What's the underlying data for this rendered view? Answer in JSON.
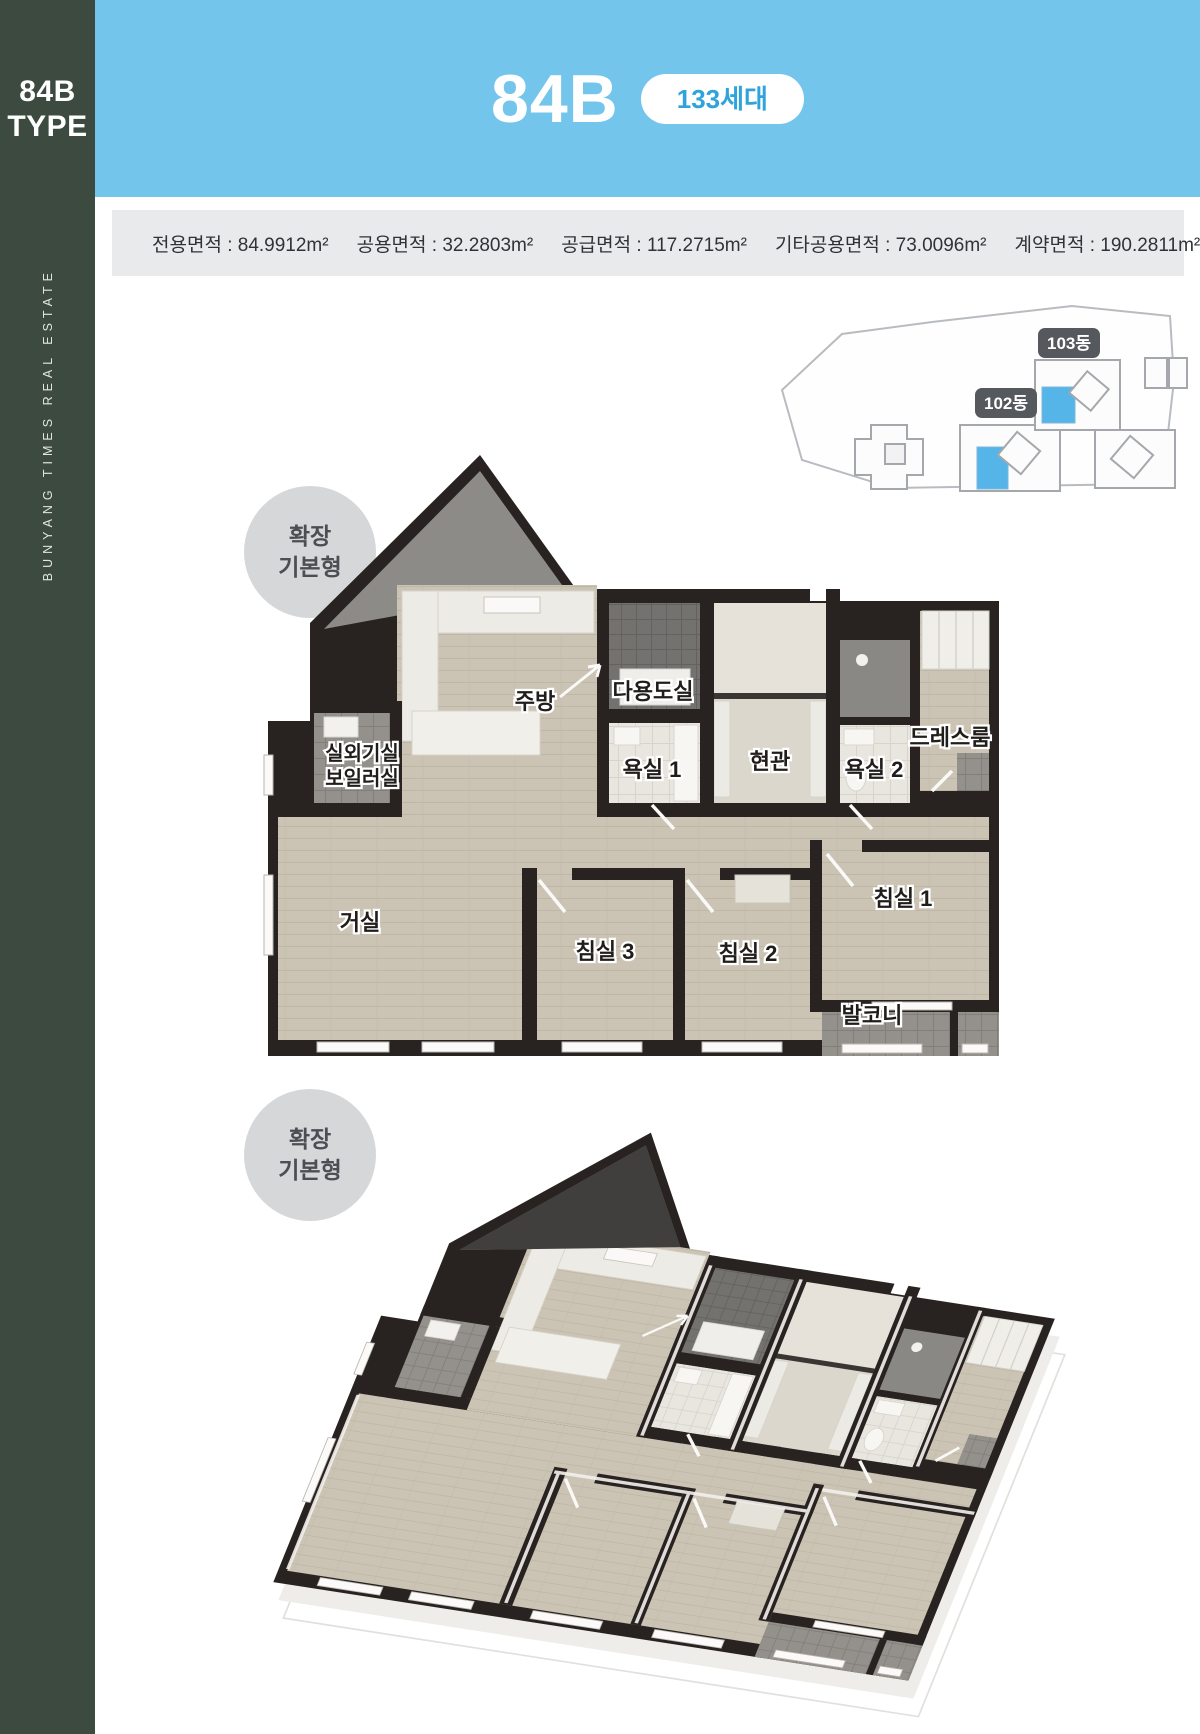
{
  "sidebar": {
    "type_line1": "84B",
    "type_line2": "TYPE",
    "vertical_text": "BUNYANG TIMES REAL ESTATE"
  },
  "header": {
    "title": "84B",
    "units_badge": "133세대"
  },
  "spec_bar": {
    "items": [
      "전용면적 : 84.9912m²",
      "공용면적 : 32.2803m²",
      "공급면적 : 117.2715m²",
      "기타공용면적 : 73.0096m²",
      "계약면적 : 190.2811m²"
    ]
  },
  "site_plan": {
    "building_103": "103동",
    "building_102": "102동",
    "highlight_color": "#55B5E9"
  },
  "plan_badge": {
    "line1": "확장",
    "line2": "기본형"
  },
  "floor_plan": {
    "rooms": {
      "kitchen": "주방",
      "utility": "다용도실",
      "outdoor_unit": "실외기실",
      "boiler": "보일러실",
      "bath1": "욕실 1",
      "entrance": "현관",
      "bath2": "욕실 2",
      "dress_room": "드레스룸",
      "living": "거실",
      "bedroom3": "침실 3",
      "bedroom2": "침실 2",
      "bedroom1": "침실 1",
      "balcony": "발코니"
    }
  },
  "colors": {
    "header_blue": "#74C5EC",
    "sidebar_green": "#3C4A40",
    "wall_dark": "#282321",
    "wood_floor": "#CBC4B4",
    "badge_gray": "#D6D7D9",
    "unit_highlight_blue": "#55B5E9"
  }
}
